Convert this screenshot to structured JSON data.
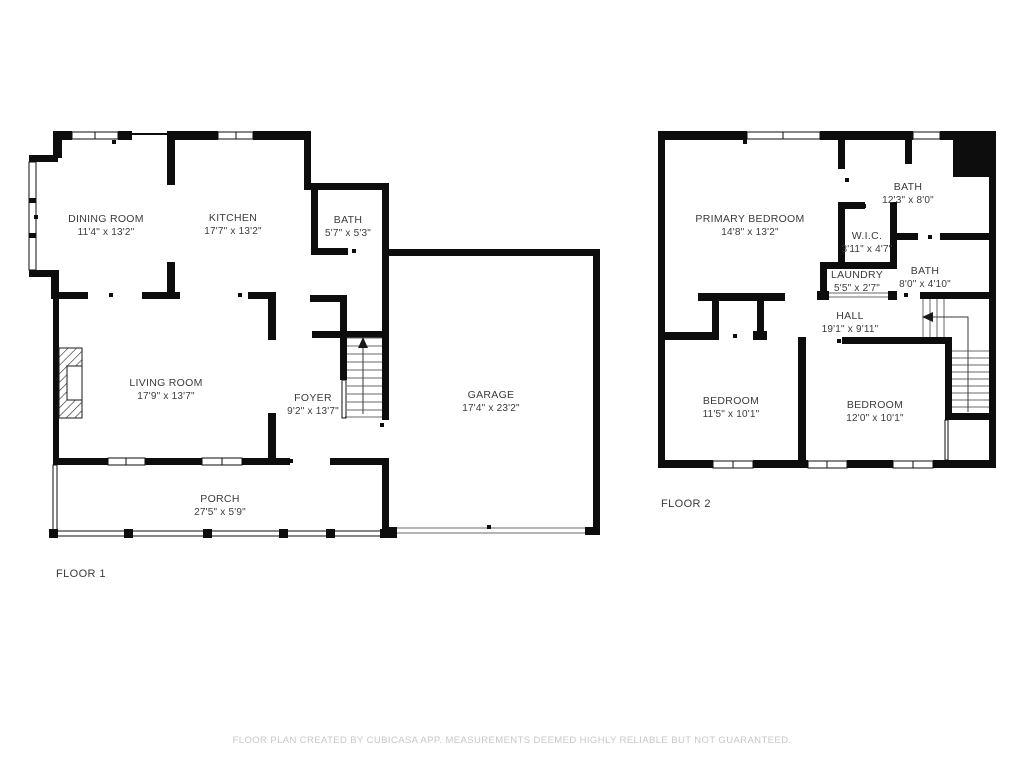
{
  "colors": {
    "wall": "#0d0d0d",
    "label": "#3b3b3b",
    "footer": "#c7c7c7"
  },
  "floor1": {
    "label": "FLOOR 1",
    "rooms": {
      "dining": {
        "name": "DINING ROOM",
        "dims": "11'4\" x 13'2\""
      },
      "kitchen": {
        "name": "KITCHEN",
        "dims": "17'7\" x 13'2\""
      },
      "bath": {
        "name": "BATH",
        "dims": "5'7\" x 5'3\""
      },
      "living": {
        "name": "LIVING ROOM",
        "dims": "17'9\" x 13'7\""
      },
      "foyer": {
        "name": "FOYER",
        "dims": "9'2\" x 13'7\""
      },
      "garage": {
        "name": "GARAGE",
        "dims": "17'4\" x 23'2\""
      },
      "porch": {
        "name": "PORCH",
        "dims": "27'5\" x 5'9\""
      }
    }
  },
  "floor2": {
    "label": "FLOOR 2",
    "rooms": {
      "primary": {
        "name": "PRIMARY BEDROOM",
        "dims": "14'8\" x 13'2\""
      },
      "bath_top": {
        "name": "BATH",
        "dims": "12'3\" x 8'0\""
      },
      "wic": {
        "name": "W.I.C.",
        "dims": "3'11\" x 4'7\""
      },
      "laundry": {
        "name": "LAUNDRY",
        "dims": "5'5\" x 2'7\""
      },
      "bath_mid": {
        "name": "BATH",
        "dims": "8'0\" x 4'10\""
      },
      "hall": {
        "name": "HALL",
        "dims": "19'1\" x 9'11\""
      },
      "bedroom1": {
        "name": "BEDROOM",
        "dims": "11'5\" x 10'1\""
      },
      "bedroom2": {
        "name": "BEDROOM",
        "dims": "12'0\" x 10'1\""
      }
    }
  },
  "footer": "FLOOR PLAN CREATED BY CUBICASA APP. MEASUREMENTS DEEMED HIGHLY RELIABLE BUT NOT GUARANTEED."
}
